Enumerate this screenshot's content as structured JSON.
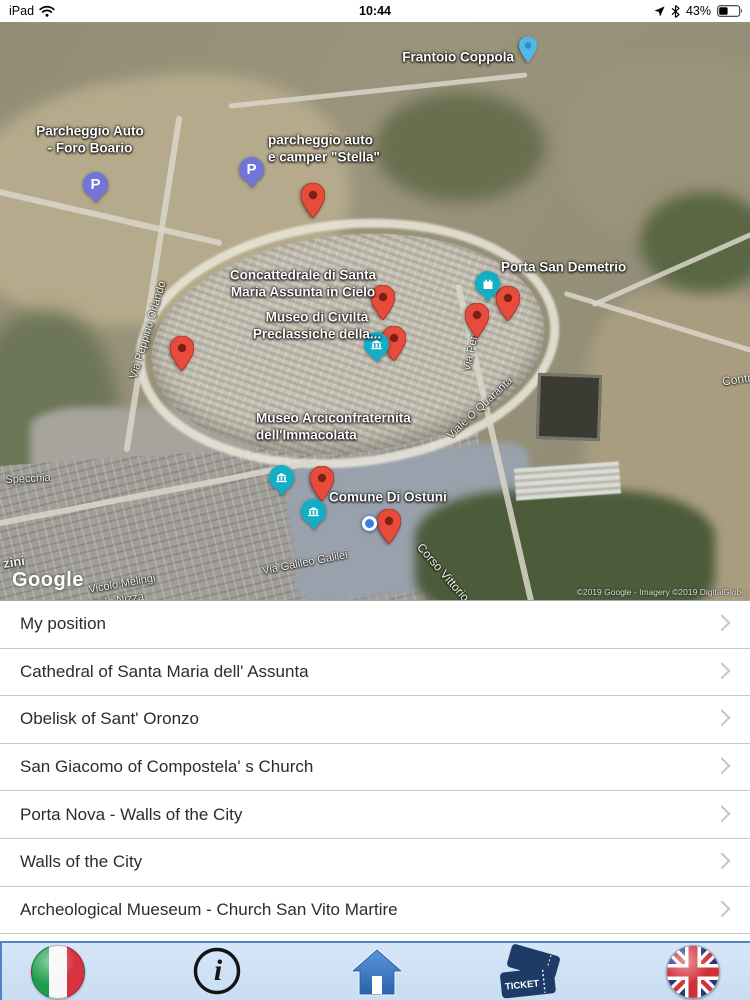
{
  "status_bar": {
    "device": "iPad",
    "time": "10:44",
    "battery_percent": "43%"
  },
  "map": {
    "watermark": "Google",
    "attribution": "©2019 Google - Imagery ©2019 DigitalGlobe",
    "parking_glyph": "P",
    "poi_labels": {
      "frantoio_coppola": "Frantoio Coppola",
      "parcheggio_foro_boario": "Parcheggio Auto\n- Foro Boario",
      "parcheggio_stella": "parcheggio auto\ne camper \"Stella\"",
      "concattedrale": "Concattedrale di Santa\nMaria Assunta in Cielo",
      "museo_civilta": "Museo di Civiltà\nPreclassiche della...",
      "porta_san_demetrio": "Porta San Demetrio",
      "museo_arciconfraternita": "Museo Arciconfraternita\ndell'Immacolata",
      "comune_di_ostuni": "Comune Di Ostuni"
    },
    "street_labels": {
      "via_peppino_orlando": "Via Peppino Orlando",
      "via_petr": "Via Petr",
      "viale_o_quaranta": "Viale O Quaranta",
      "specchia": "Specchia",
      "zini": "zini",
      "vicolo_melingi": "Vicolo Melingi",
      "vicolo_nizza": "Vicolo Nizza",
      "bonasforza": "Bonasforza",
      "via_galileo_galilei": "Via Galileo Galilei",
      "corso_vittorio_emanuele": "Corso Vittorio Emanuele",
      "contrada": "Contra"
    }
  },
  "list": {
    "items": [
      {
        "label": "My position"
      },
      {
        "label": "Cathedral of Santa Maria dell' Assunta"
      },
      {
        "label": "Obelisk of Sant' Oronzo"
      },
      {
        "label": "San Giacomo of Compostela' s Church"
      },
      {
        "label": "Porta Nova - Walls of the City"
      },
      {
        "label": "Walls of the City"
      },
      {
        "label": "Archeological Mueseum - Church San Vito Martire"
      }
    ]
  },
  "toolbar": {
    "info_glyph": "i",
    "ticket_label": "TICKET"
  }
}
